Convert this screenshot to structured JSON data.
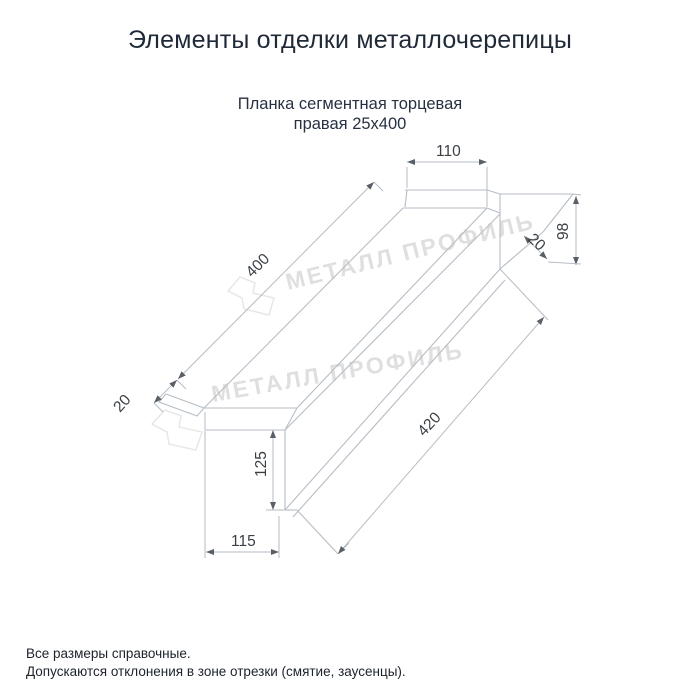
{
  "page": {
    "title": "Элементы отделки металлочерепицы",
    "subtitle_line1": "Планка сегментная торцевая",
    "subtitle_line2": "правая 25х400"
  },
  "drawing": {
    "type": "technical-drawing",
    "dims": {
      "top_width": "110",
      "length_top": "400",
      "hem_near": "20",
      "hem_far": "20",
      "height_far": "98",
      "height_near": "125",
      "bottom_width": "115",
      "length_bottom": "420"
    },
    "watermark_text": "МЕТАЛЛ ПРОФИЛЬ"
  },
  "footer": {
    "note1": "Все размеры справочные.",
    "note2": "Допускаются отклонения в зоне отрезки (смятие, заусенцы)."
  },
  "colors": {
    "line": "#b6bdc5",
    "arrow": "#5a6067",
    "dim_text": "#3a3f45",
    "title_text": "#1f2937",
    "watermark": "#dfdfdf"
  }
}
